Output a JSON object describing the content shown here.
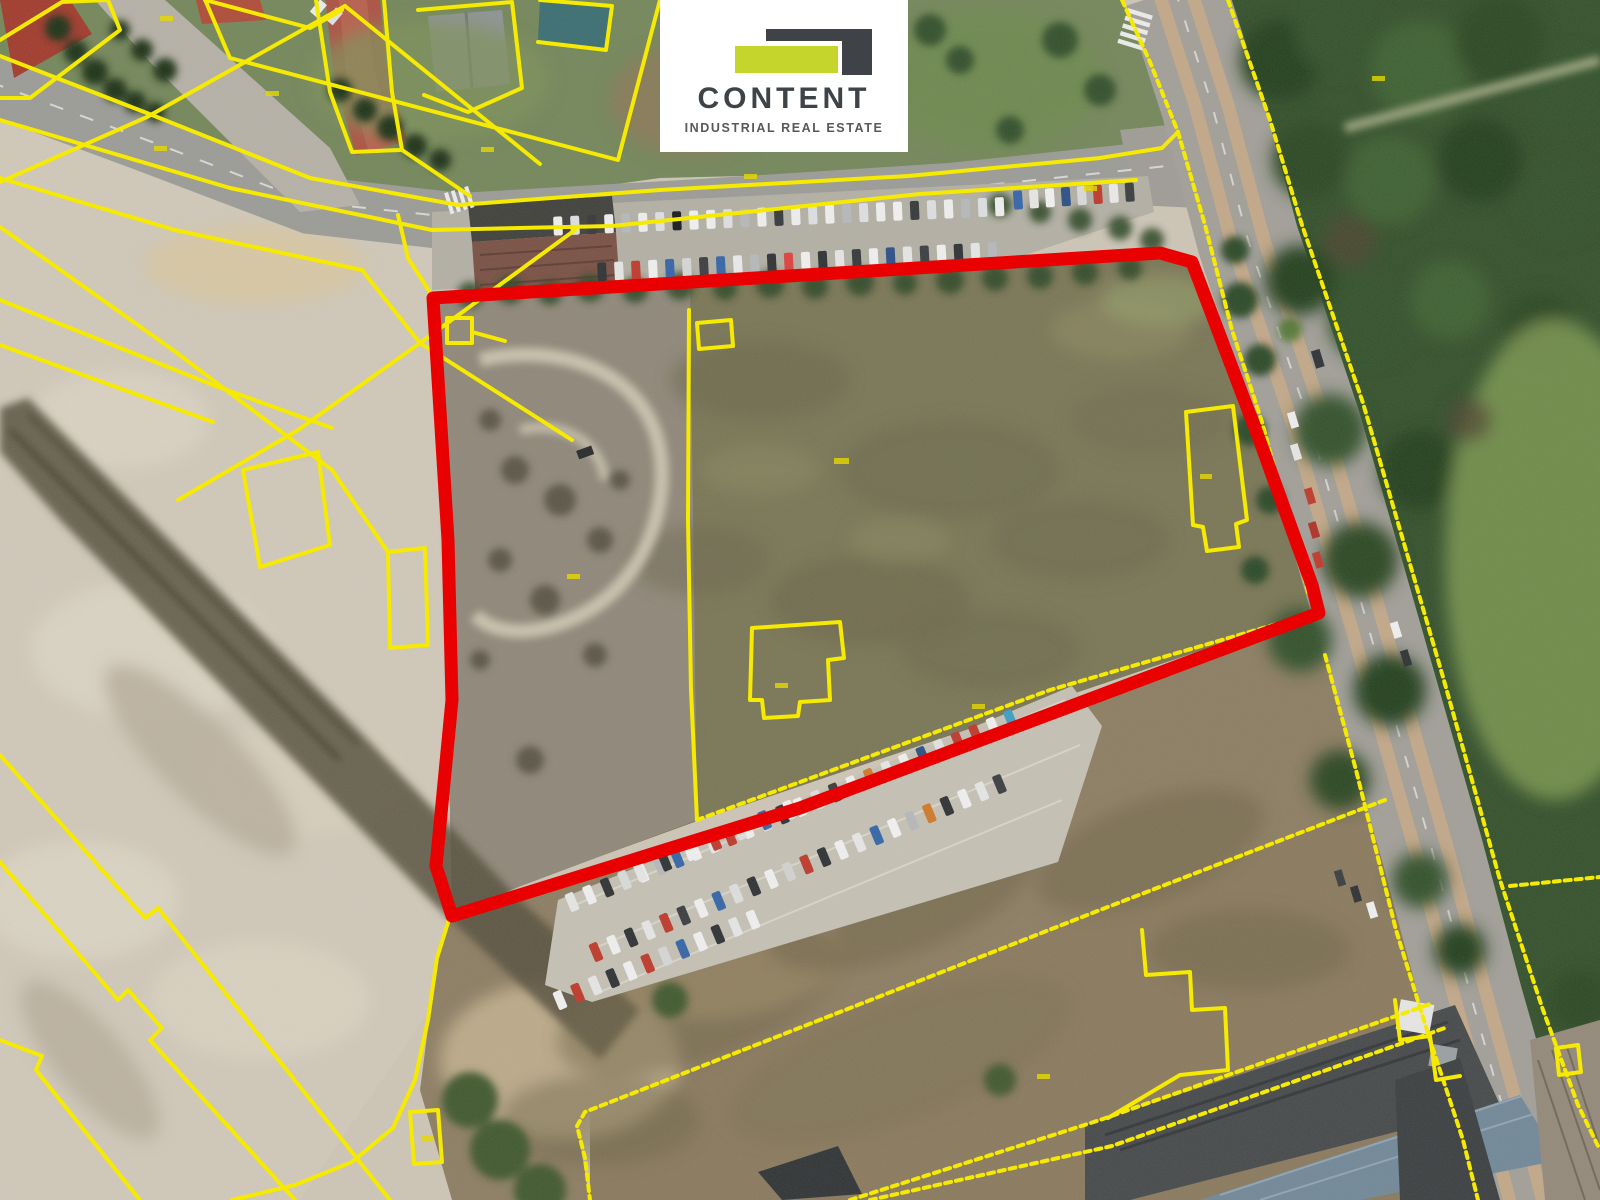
{
  "logo": {
    "title": "CONTENT",
    "subtitle": "INDUSTRIAL REAL ESTATE",
    "mark_dark_color": "#3f4347",
    "mark_lime_color": "#c6d52b",
    "card_background": "#ffffff"
  },
  "map": {
    "type": "aerial-photo-with-cadastral-overlay",
    "red_outline_color": "#e90000",
    "parcel_line_color": "#f6ea00",
    "red_outline_points": "433,298 1160,253 1192,262 1258,436 1312,585 1319,613 800,808 452,916 436,866 452,700 448,540",
    "lines": [
      {
        "name": "road-north-edge",
        "points": "0,56 152,115 310,178 458,205 660,190 908,176 1100,158"
      },
      {
        "name": "road-south-edge",
        "points": "0,120 230,188 432,230 612,226 920,194 1136,180"
      },
      {
        "name": "road-south-inner",
        "points": "0,178 175,230 362,270"
      },
      {
        "name": "nw-diagonal-a",
        "points": "0,182 147,117 345,6"
      },
      {
        "name": "nw-diagonal-b",
        "points": "362,270 420,343 572,440"
      },
      {
        "name": "nw-diagonal-c",
        "points": "575,230 420,343 298,430 178,500"
      },
      {
        "name": "house1-parcel",
        "points": "0,40 62,2 108,0 120,30 30,98 0,98"
      },
      {
        "name": "house2-parcel",
        "points": "205,0 310,28 342,10"
      },
      {
        "name": "yard-boundary",
        "points": "660,0 618,160 230,58 206,2"
      },
      {
        "name": "yard-inner-line",
        "points": "345,6 540,164"
      },
      {
        "name": "house3-parcel",
        "points": "418,10 512,2 522,88 468,112 424,95"
      },
      {
        "name": "house4-parcel",
        "points": "540,0 612,6 606,50 538,42"
      },
      {
        "name": "track-west-edge",
        "points": "316,0 330,92 352,152 400,150"
      },
      {
        "name": "track-east-edge",
        "points": "384,0 392,92 402,150 470,196"
      },
      {
        "name": "tram-west-edge-upper",
        "points": "1122,0 1150,62 1178,132 1205,225 1232,330 1262,422 1308,592"
      },
      {
        "name": "tram-west-edge-lower",
        "points": "1325,655 1356,770 1396,930 1430,1040 1463,1140 1478,1200"
      },
      {
        "name": "tram-east-edge",
        "points": "1228,0 1270,120 1302,225 1363,403 1443,677 1500,880 1543,1010 1578,1105 1600,1150"
      },
      {
        "name": "east-spur",
        "points": "1510,886 1600,877"
      },
      {
        "name": "parking-south-line",
        "points": "433,296 700,282 1000,267 1160,254"
      },
      {
        "name": "inner-parcel-nw",
        "points": "447,318 472,318 472,343 447,343 447,318"
      },
      {
        "name": "inner-parcel-nw-tail",
        "points": "472,332 505,341"
      },
      {
        "name": "inner-parcel-top",
        "points": "697,323 731,320 733,346 699,349 697,323"
      },
      {
        "name": "inner-parcel-house",
        "points": "752,628 840,622 844,658 828,660 830,700 800,702 798,716 764,718 762,700 750,700 752,628"
      },
      {
        "name": "inner-parcel-narrow",
        "points": "1186,412 1233,406 1247,520 1236,524 1239,547 1207,551 1203,527 1193,525 1186,412"
      },
      {
        "name": "field-west-line",
        "points": "689,310 688,520 691,690 697,820"
      },
      {
        "name": "field-south-line",
        "points": "697,820 1050,690 1318,612"
      },
      {
        "name": "southwest-curve",
        "points": "450,916 437,958 428,1020 415,1080 393,1128 352,1162 295,1185 232,1200"
      },
      {
        "name": "small-building-parcel",
        "points": "410,1112 438,1110 442,1162 414,1164 410,1112"
      },
      {
        "name": "scrub-boundary",
        "points": "1385,800 1100,910 585,1112 577,1126 585,1158 590,1200"
      },
      {
        "name": "stepped-boundary",
        "points": "1142,930 1146,975 1190,972 1192,1010 1225,1008 1228,1070 1180,1075 1108,1118"
      },
      {
        "name": "depot-front-line-a",
        "points": "850,1200 1100,1120 1433,1003"
      },
      {
        "name": "depot-front-line-b",
        "points": "870,1200 1112,1146 1445,1028"
      },
      {
        "name": "strip-a",
        "points": "0,755 145,918 158,908 390,1200"
      },
      {
        "name": "strip-b",
        "points": "0,862 118,1000 128,990 162,1028 150,1040 295,1200"
      },
      {
        "name": "strip-c",
        "points": "0,1040 42,1056 36,1070 140,1200"
      },
      {
        "name": "strip-d",
        "points": "0,227 173,350 332,470"
      },
      {
        "name": "strip-e",
        "points": "0,300 213,385 332,428"
      },
      {
        "name": "strip-f",
        "points": "0,345 213,422"
      },
      {
        "name": "mid-parcel-quad",
        "points": "243,470 318,452 330,545 260,567 243,470"
      },
      {
        "name": "mid-parcel-link",
        "points": "332,470 388,552"
      },
      {
        "name": "small-building-west",
        "points": "388,552 425,548 428,645 390,648 388,552"
      },
      {
        "name": "intersection-curve",
        "points": "1100,158 1162,148 1178,132"
      },
      {
        "name": "bottom-right-step",
        "points": "1395,1000 1400,1040 1430,1036 1436,1080 1460,1076"
      },
      {
        "name": "tiny-parcel-br",
        "points": "1556,1048 1578,1045 1581,1072 1559,1075 1556,1048"
      },
      {
        "name": "site-entrance",
        "points": "398,215 408,258 433,297"
      }
    ]
  }
}
